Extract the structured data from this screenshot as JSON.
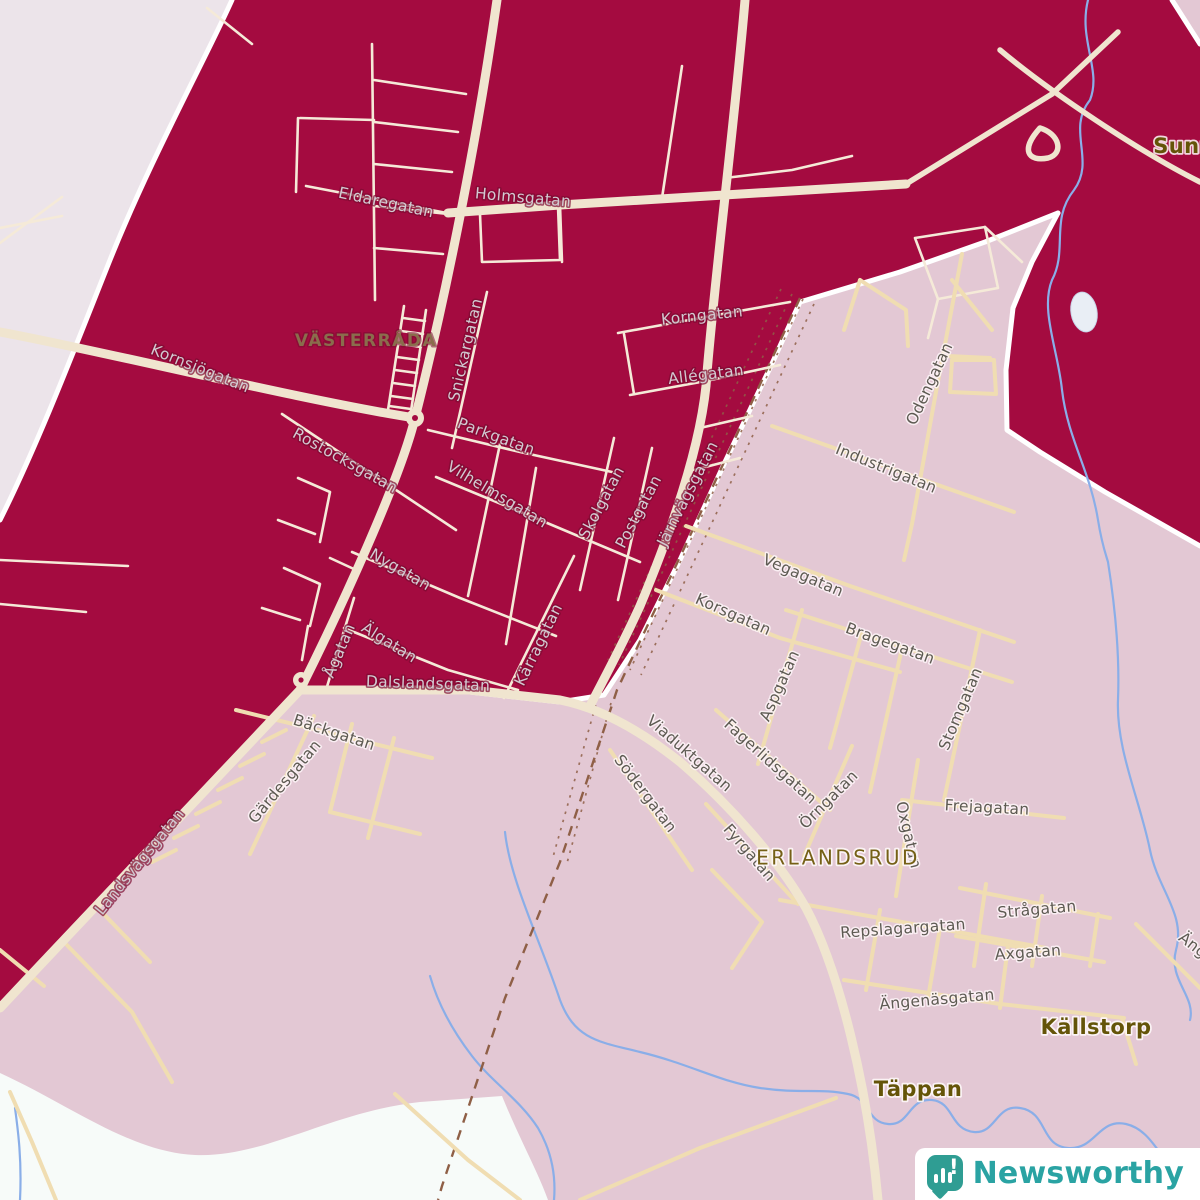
{
  "map": {
    "colors": {
      "region_dark": "#a40b40",
      "region_pink": "#e3c8d4",
      "region_outer": "#ece4ea",
      "region_unshaded": "#f7fbf9",
      "road_major": "#f0e5cf",
      "road_town": "#f5ead8",
      "road_tan": "#f0ddb2",
      "river": "#8aaee8",
      "railway": "#8f5f46",
      "boundary": "#ffffff",
      "label_on_dark": "#d2cad1",
      "label_on_light": "#5d5a52",
      "place_dark": "#8a6d4c"
    },
    "place_labels": [
      {
        "text": "VÄSTERRÅDA",
        "x": 366,
        "y": 341,
        "rot": 0,
        "style": "town-dark"
      },
      {
        "text": "ERLANDSRUD",
        "x": 838,
        "y": 859,
        "rot": 0,
        "style": "district"
      },
      {
        "text": "Källstorp",
        "x": 1096,
        "y": 1028,
        "rot": 0,
        "style": "locality"
      },
      {
        "text": "Täppan",
        "x": 918,
        "y": 1090,
        "rot": 0,
        "style": "locality"
      },
      {
        "text": "Sunn",
        "x": 1184,
        "y": 147,
        "rot": 0,
        "style": "locality"
      }
    ],
    "street_labels": [
      {
        "text": "Eldaregatan",
        "x": 386,
        "y": 203,
        "rot": 12,
        "theme": "dark"
      },
      {
        "text": "Holmsgatan",
        "x": 523,
        "y": 198,
        "rot": 5,
        "theme": "dark"
      },
      {
        "text": "Kornsjögatan",
        "x": 200,
        "y": 369,
        "rot": 22,
        "theme": "dark"
      },
      {
        "text": "Snickargatan",
        "x": 466,
        "y": 350,
        "rot": -77,
        "theme": "dark"
      },
      {
        "text": "Korngatan",
        "x": 702,
        "y": 316,
        "rot": -6,
        "theme": "dark"
      },
      {
        "text": "Allégatan",
        "x": 706,
        "y": 375,
        "rot": -7,
        "theme": "dark"
      },
      {
        "text": "Parkgatan",
        "x": 496,
        "y": 437,
        "rot": 20,
        "theme": "dark"
      },
      {
        "text": "Rostocksgatan",
        "x": 345,
        "y": 461,
        "rot": 29,
        "theme": "dark"
      },
      {
        "text": "Vilhelmsgatan",
        "x": 497,
        "y": 495,
        "rot": 31,
        "theme": "dark"
      },
      {
        "text": "Skolgatan",
        "x": 602,
        "y": 503,
        "rot": -62,
        "theme": "dark"
      },
      {
        "text": "Postgatan",
        "x": 639,
        "y": 512,
        "rot": -62,
        "theme": "dark"
      },
      {
        "text": "Järnvägsgatan",
        "x": 688,
        "y": 494,
        "rot": -63,
        "theme": "dark"
      },
      {
        "text": "Nygatan",
        "x": 400,
        "y": 570,
        "rot": 30,
        "theme": "dark"
      },
      {
        "text": "Ågatan",
        "x": 340,
        "y": 651,
        "rot": -67,
        "theme": "dark"
      },
      {
        "text": "Älgatan",
        "x": 389,
        "y": 643,
        "rot": 32,
        "theme": "dark"
      },
      {
        "text": "Kärragatan",
        "x": 539,
        "y": 645,
        "rot": -64,
        "theme": "dark"
      },
      {
        "text": "Dalslandsgatan",
        "x": 428,
        "y": 684,
        "rot": 2,
        "theme": "dark"
      },
      {
        "text": "Landsvägsgatan",
        "x": 140,
        "y": 862,
        "rot": -51,
        "theme": "dark"
      },
      {
        "text": "Bäckgatan",
        "x": 334,
        "y": 733,
        "rot": 18,
        "theme": "light"
      },
      {
        "text": "Gärdesgatan",
        "x": 285,
        "y": 782,
        "rot": -50,
        "theme": "light"
      },
      {
        "text": "Viaduktgatan",
        "x": 689,
        "y": 754,
        "rot": 41,
        "theme": "light"
      },
      {
        "text": "Södergatan",
        "x": 645,
        "y": 794,
        "rot": 53,
        "theme": "light"
      },
      {
        "text": "Fagerlidsgatan",
        "x": 770,
        "y": 762,
        "rot": 42,
        "theme": "light"
      },
      {
        "text": "Örngatan",
        "x": 829,
        "y": 800,
        "rot": -45,
        "theme": "light"
      },
      {
        "text": "Fyrgatan",
        "x": 749,
        "y": 853,
        "rot": 49,
        "theme": "light"
      },
      {
        "text": "Korsgatan",
        "x": 733,
        "y": 615,
        "rot": 24,
        "theme": "light"
      },
      {
        "text": "Aspgatan",
        "x": 780,
        "y": 686,
        "rot": -66,
        "theme": "light"
      },
      {
        "text": "Vegagatan",
        "x": 803,
        "y": 576,
        "rot": 23,
        "theme": "light"
      },
      {
        "text": "Bragegatan",
        "x": 890,
        "y": 644,
        "rot": 20,
        "theme": "light"
      },
      {
        "text": "Stomgatan",
        "x": 961,
        "y": 709,
        "rot": -67,
        "theme": "light"
      },
      {
        "text": "Odengatan",
        "x": 930,
        "y": 384,
        "rot": -65,
        "theme": "light"
      },
      {
        "text": "Industrigatan",
        "x": 886,
        "y": 469,
        "rot": 22,
        "theme": "light"
      },
      {
        "text": "Oxgatan",
        "x": 908,
        "y": 835,
        "rot": 77,
        "theme": "light"
      },
      {
        "text": "Frejagatan",
        "x": 987,
        "y": 808,
        "rot": 3,
        "theme": "light"
      },
      {
        "text": "Repslagargatan",
        "x": 903,
        "y": 929,
        "rot": -4,
        "theme": "light"
      },
      {
        "text": "Strågatan",
        "x": 1037,
        "y": 910,
        "rot": -5,
        "theme": "light"
      },
      {
        "text": "Axgatan",
        "x": 1028,
        "y": 953,
        "rot": -4,
        "theme": "light"
      },
      {
        "text": "Ängenäsgatan",
        "x": 937,
        "y": 1000,
        "rot": -5,
        "theme": "light"
      },
      {
        "text": "Ängs",
        "x": 1196,
        "y": 948,
        "rot": 38,
        "theme": "light"
      }
    ]
  },
  "logo": {
    "text": "Newsworthy",
    "icon": "newsworthy-chart-bubble-icon",
    "icon_color": "#2f9d93",
    "text_color": "#2aa3a3"
  }
}
